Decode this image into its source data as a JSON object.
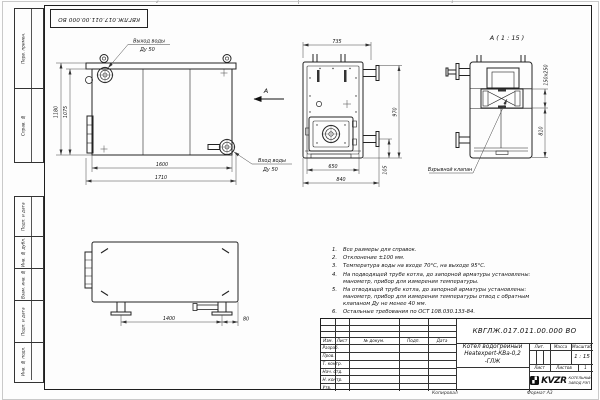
{
  "sheet": {
    "top_stamp": "КВГЛЖ.017.011.00.000 ВО",
    "zone_left": "2",
    "zone_right": "1"
  },
  "margin": {
    "cells_top": [
      {
        "label": "Перв. примен."
      },
      {
        "label": "Справ. №"
      }
    ],
    "cells_bottom": [
      {
        "label": "Подп. и дата"
      },
      {
        "label": "Инв. № дубл."
      },
      {
        "label": "Взам. инв. №"
      },
      {
        "label": "Подп. и дата"
      },
      {
        "label": "Инв. № подл."
      }
    ]
  },
  "views": {
    "side": {
      "d1180": "1180",
      "d1075": "1075",
      "d1600": "1600",
      "d1710": "1710",
      "outlet1": "Выход воды",
      "outlet2": "Ду 50",
      "inlet1": "Вход воды",
      "inlet2": "Ду 50",
      "arrow": "А"
    },
    "front": {
      "d735": "735",
      "d970": "970",
      "d650": "650",
      "d840": "840",
      "d105": "105"
    },
    "detail": {
      "title": "А ( 1 : 15 )",
      "d_vent": "150х250",
      "d810": "810",
      "callout": "Взрывной клапан"
    },
    "top": {
      "d1400": "1400",
      "d80": "80"
    }
  },
  "notes": {
    "items": [
      {
        "n": "1.",
        "text": "Все размеры для справок."
      },
      {
        "n": "2.",
        "text": "Отклонение ±100 мм."
      },
      {
        "n": "3.",
        "text": "Температура воды на входе 70°С, на выходе 95°С."
      },
      {
        "n": "4.",
        "text": "На подводящей трубе котла, до запорной арматуры установлены:\nманометр, прибор для измерения температуры."
      },
      {
        "n": "5.",
        "text": "На отводящей трубе котла, до запорной арматуры установлены:\nманометр, прибор для измерения температуры  отвод с обратным\nклапаном Ду не менее 40 мм."
      },
      {
        "n": "6.",
        "text": "Остальные требования по ОСТ 108.030.133-84."
      }
    ]
  },
  "title_block": {
    "doc_number": "КВГЛЖ.017.011.00.000 ВО",
    "name1": "Котел водогрейный",
    "name2": "Heatexpert-КВа-0,2 -ГЛЖ",
    "header": [
      "Изм.",
      "Лист",
      "№ докум.",
      "Подп.",
      "Дата"
    ],
    "roles": [
      "Разраб.",
      "Пров.",
      "Т. контр.",
      "Нач. отд.",
      "Н. контр.",
      "Утв."
    ],
    "lit_label": "Лит.",
    "mass_label": "Масса",
    "scale_label": "Масштаб",
    "scale_value": "1 : 15",
    "sheet_label": "Лист",
    "sheets_label": "Листов",
    "sheets_value": "1",
    "logo_text": "KVZR",
    "company1": "КОТЕЛЬНЫЙ",
    "company2": "ЗАВОД РЭП"
  },
  "footer": {
    "copied": "Копировал",
    "format": "Формат А3"
  }
}
